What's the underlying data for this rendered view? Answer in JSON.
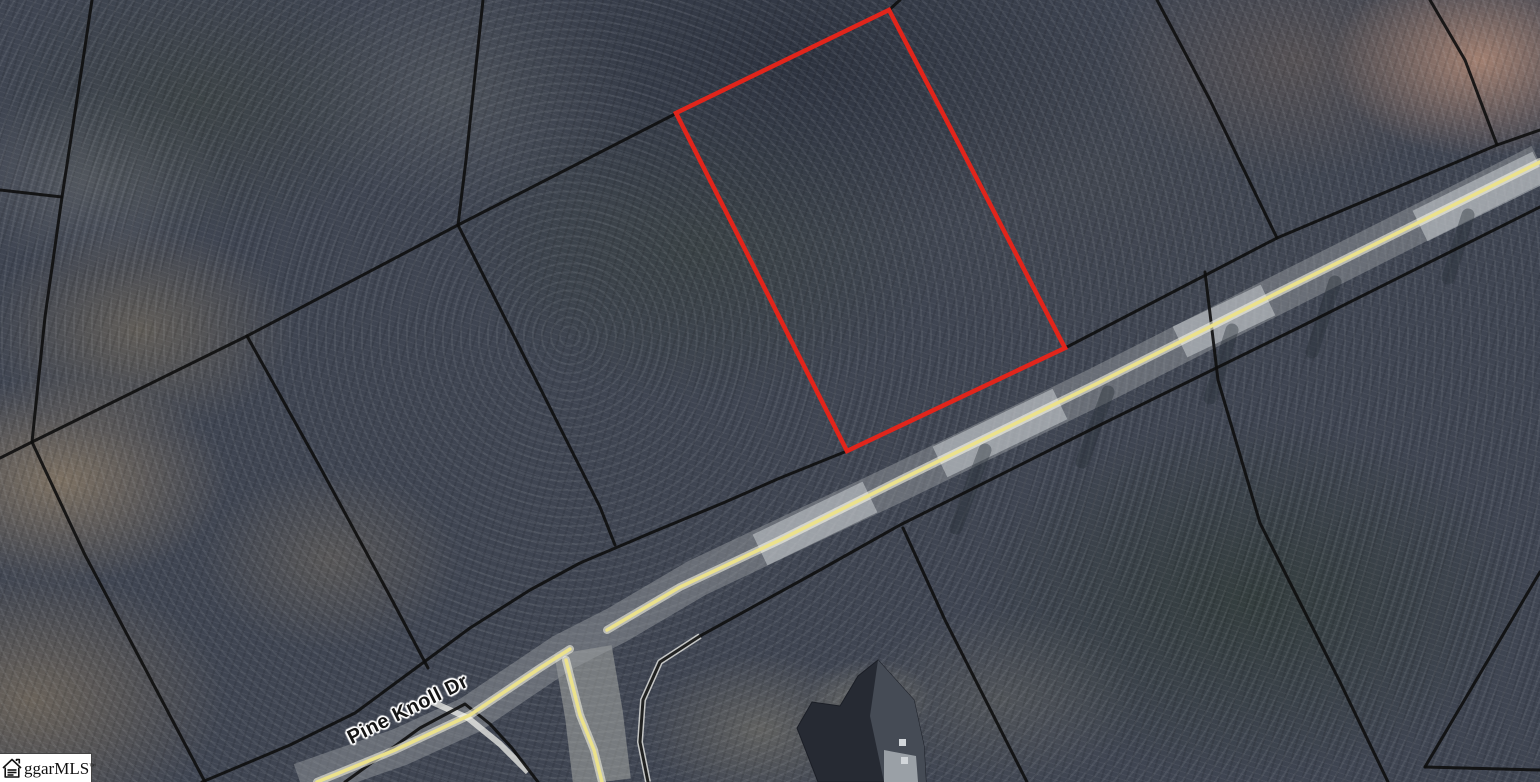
{
  "map": {
    "street_label": "Pine Knoll Dr",
    "watermark": {
      "text": "ggarMLS",
      "tm": "™",
      "icon": "house-icon"
    },
    "colors": {
      "parcel_highlight": "#e1251b",
      "boundary_line": "#0e0e0e",
      "road_centerline": "#ece28b",
      "watermark_bg": "#ffffff"
    }
  },
  "geometry": {
    "width": 1540,
    "height": 782,
    "features": [
      {
        "name": "side-road-surface",
        "class": "side-band",
        "shape": "polyline",
        "points": [
          [
            583,
            650
          ],
          [
            594,
            715
          ],
          [
            602,
            782
          ]
        ]
      },
      {
        "name": "main-road-surface",
        "class": "road-band",
        "shape": "polyline",
        "points": [
          [
            300,
            782
          ],
          [
            400,
            747
          ],
          [
            470,
            715
          ],
          [
            562,
            653
          ],
          [
            617,
            625
          ],
          [
            697,
            578
          ],
          [
            900,
            482
          ],
          [
            1100,
            385
          ],
          [
            1283,
            292
          ],
          [
            1540,
            163
          ]
        ]
      },
      {
        "name": "road-light-patch",
        "class": "road-light",
        "shape": "polyline",
        "points": [
          [
            760,
            550
          ],
          [
            870,
            497
          ]
        ]
      },
      {
        "name": "road-light-patch",
        "class": "road-light",
        "shape": "polyline",
        "points": [
          [
            940,
            462
          ],
          [
            1060,
            404
          ]
        ]
      },
      {
        "name": "road-light-patch",
        "class": "road-light",
        "shape": "polyline",
        "points": [
          [
            1180,
            342
          ],
          [
            1268,
            300
          ]
        ]
      },
      {
        "name": "road-light-patch",
        "class": "road-light",
        "shape": "polyline",
        "points": [
          [
            1420,
            226
          ],
          [
            1540,
            167
          ]
        ]
      },
      {
        "name": "tree-shadow-streak",
        "class": "shadow-streak",
        "shape": "polyline",
        "points": [
          [
            985,
            450
          ],
          [
            956,
            528
          ]
        ]
      },
      {
        "name": "tree-shadow-streak",
        "class": "shadow-streak",
        "shape": "polyline",
        "points": [
          [
            1108,
            392
          ],
          [
            1082,
            462
          ]
        ]
      },
      {
        "name": "tree-shadow-streak",
        "class": "shadow-streak",
        "shape": "polyline",
        "points": [
          [
            1232,
            330
          ],
          [
            1210,
            398
          ]
        ]
      },
      {
        "name": "tree-shadow-streak",
        "class": "shadow-streak",
        "shape": "polyline",
        "points": [
          [
            1335,
            282
          ],
          [
            1312,
            352
          ]
        ]
      },
      {
        "name": "tree-shadow-streak",
        "class": "shadow-streak",
        "shape": "polyline",
        "points": [
          [
            1468,
            215
          ],
          [
            1448,
            278
          ]
        ]
      },
      {
        "name": "curb-edge-white",
        "class": "white-curb",
        "shape": "polyline",
        "points": [
          [
            700,
            636
          ],
          [
            660,
            662
          ],
          [
            643,
            700
          ],
          [
            640,
            742
          ],
          [
            648,
            782
          ]
        ]
      },
      {
        "name": "curb-edge-white",
        "class": "white-curb",
        "shape": "polyline",
        "points": [
          [
            432,
            702
          ],
          [
            468,
            718
          ],
          [
            500,
            744
          ],
          [
            528,
            772
          ]
        ]
      },
      {
        "name": "parcel-boundary",
        "class": "black-line",
        "shape": "polyline",
        "points": [
          [
            92,
            0
          ],
          [
            83,
            60
          ],
          [
            62,
            197
          ],
          [
            45,
            317
          ],
          [
            32,
            442
          ]
        ]
      },
      {
        "name": "parcel-boundary",
        "class": "black-line",
        "shape": "polyline",
        "points": [
          [
            62,
            197
          ],
          [
            0,
            190
          ]
        ]
      },
      {
        "name": "parcel-boundary",
        "class": "black-line",
        "shape": "polyline",
        "points": [
          [
            247,
            336
          ],
          [
            32,
            442
          ],
          [
            0,
            458
          ]
        ]
      },
      {
        "name": "parcel-boundary",
        "class": "black-line",
        "shape": "polyline",
        "points": [
          [
            32,
            442
          ],
          [
            85,
            555
          ],
          [
            130,
            640
          ],
          [
            205,
            782
          ]
        ]
      },
      {
        "name": "parcel-boundary",
        "class": "black-line",
        "shape": "polyline",
        "points": [
          [
            483,
            0
          ],
          [
            466,
            160
          ],
          [
            458,
            225
          ]
        ]
      },
      {
        "name": "parcel-boundary",
        "class": "black-line",
        "shape": "polyline",
        "points": [
          [
            458,
            225
          ],
          [
            247,
            336
          ]
        ]
      },
      {
        "name": "parcel-boundary",
        "class": "black-line",
        "shape": "polyline",
        "points": [
          [
            247,
            336
          ],
          [
            320,
            467
          ],
          [
            392,
            600
          ],
          [
            428,
            668
          ]
        ]
      },
      {
        "name": "parcel-boundary",
        "class": "black-line",
        "shape": "polyline",
        "points": [
          [
            458,
            225
          ],
          [
            600,
            507
          ],
          [
            615,
            545
          ]
        ]
      },
      {
        "name": "parcel-boundary",
        "class": "black-line",
        "shape": "polyline",
        "points": [
          [
            458,
            225
          ],
          [
            677,
            113
          ]
        ]
      },
      {
        "name": "parcel-boundary",
        "class": "black-line",
        "shape": "polyline",
        "points": [
          [
            889,
            10
          ],
          [
            900,
            0
          ]
        ]
      },
      {
        "name": "road-frontage-boundary",
        "class": "black-line",
        "shape": "polyline",
        "points": [
          [
            202,
            782
          ],
          [
            290,
            745
          ],
          [
            355,
            713
          ],
          [
            420,
            665
          ],
          [
            470,
            628
          ],
          [
            530,
            590
          ],
          [
            580,
            563
          ],
          [
            653,
            532
          ],
          [
            723,
            503
          ],
          [
            780,
            478
          ],
          [
            847,
            451
          ],
          [
            1065,
            348
          ],
          [
            1277,
            238
          ],
          [
            1497,
            145
          ],
          [
            1540,
            130
          ]
        ]
      },
      {
        "name": "parcel-boundary",
        "class": "black-line",
        "shape": "polyline",
        "points": [
          [
            1157,
            0
          ],
          [
            1210,
            100
          ],
          [
            1277,
            238
          ]
        ]
      },
      {
        "name": "parcel-boundary",
        "class": "black-line",
        "shape": "polyline",
        "points": [
          [
            1430,
            0
          ],
          [
            1465,
            60
          ],
          [
            1497,
            145
          ]
        ]
      },
      {
        "name": "road-lower-curb",
        "class": "black-line",
        "shape": "polyline",
        "points": [
          [
            345,
            782
          ],
          [
            420,
            728
          ],
          [
            465,
            704
          ],
          [
            490,
            724
          ],
          [
            512,
            748
          ],
          [
            538,
            782
          ]
        ]
      },
      {
        "name": "road-lower-curb",
        "class": "black-line",
        "shape": "polyline",
        "points": [
          [
            648,
            782
          ],
          [
            640,
            742
          ],
          [
            643,
            700
          ],
          [
            660,
            662
          ],
          [
            700,
            636
          ],
          [
            820,
            570
          ],
          [
            900,
            525
          ],
          [
            1100,
            425
          ],
          [
            1300,
            327
          ],
          [
            1540,
            207
          ]
        ]
      },
      {
        "name": "parcel-boundary",
        "class": "black-line",
        "shape": "polyline",
        "points": [
          [
            1205,
            272
          ],
          [
            1218,
            380
          ],
          [
            1260,
            523
          ],
          [
            1340,
            682
          ],
          [
            1388,
            782
          ]
        ]
      },
      {
        "name": "parcel-boundary",
        "class": "black-line",
        "shape": "polyline",
        "points": [
          [
            903,
            528
          ],
          [
            945,
            620
          ],
          [
            1027,
            782
          ]
        ]
      },
      {
        "name": "parcel-boundary",
        "class": "black-line",
        "shape": "polyline",
        "points": [
          [
            1540,
            572
          ],
          [
            1425,
            767
          ]
        ]
      },
      {
        "name": "parcel-boundary",
        "class": "black-line",
        "shape": "polyline",
        "points": [
          [
            1425,
            767
          ],
          [
            1540,
            770
          ]
        ]
      },
      {
        "name": "highlighted-parcel-outline",
        "class": "red-parcel",
        "shape": "polygon",
        "points": [
          [
            889,
            10
          ],
          [
            1065,
            348
          ],
          [
            847,
            451
          ],
          [
            676,
            113
          ]
        ]
      },
      {
        "name": "road-centerline-glow",
        "class": "yellow-glow",
        "shape": "polyline",
        "points": [
          [
            317,
            782
          ],
          [
            395,
            750
          ],
          [
            470,
            715
          ],
          [
            540,
            668
          ],
          [
            570,
            649
          ]
        ]
      },
      {
        "name": "road-centerline-glow",
        "class": "yellow-glow",
        "shape": "polyline",
        "points": [
          [
            607,
            630
          ],
          [
            680,
            587
          ],
          [
            780,
            540
          ],
          [
            900,
            480
          ],
          [
            1100,
            382
          ],
          [
            1283,
            290
          ],
          [
            1540,
            162
          ]
        ]
      },
      {
        "name": "road-centerline-glow",
        "class": "yellow-glow",
        "shape": "polyline",
        "points": [
          [
            566,
            660
          ],
          [
            580,
            715
          ],
          [
            594,
            750
          ],
          [
            602,
            782
          ]
        ]
      },
      {
        "name": "road-centerline",
        "class": "yellow-line",
        "shape": "polyline",
        "points": [
          [
            317,
            782
          ],
          [
            395,
            750
          ],
          [
            470,
            715
          ],
          [
            540,
            668
          ],
          [
            570,
            649
          ]
        ]
      },
      {
        "name": "road-centerline",
        "class": "yellow-line",
        "shape": "polyline",
        "points": [
          [
            607,
            630
          ],
          [
            680,
            587
          ],
          [
            780,
            540
          ],
          [
            900,
            480
          ],
          [
            1100,
            382
          ],
          [
            1283,
            290
          ],
          [
            1540,
            162
          ]
        ]
      },
      {
        "name": "road-centerline",
        "class": "yellow-line",
        "shape": "polyline",
        "points": [
          [
            566,
            660
          ],
          [
            580,
            715
          ],
          [
            594,
            750
          ],
          [
            602,
            782
          ]
        ]
      },
      {
        "name": "house-roof",
        "class": "house-roof",
        "shape": "polygon",
        "points": [
          [
            878,
            660
          ],
          [
            914,
            700
          ],
          [
            924,
            746
          ],
          [
            926,
            782
          ],
          [
            818,
            782
          ],
          [
            797,
            728
          ],
          [
            812,
            702
          ],
          [
            840,
            706
          ],
          [
            858,
            676
          ]
        ]
      },
      {
        "name": "house-roof-facet",
        "class": "house-facet",
        "shape": "polygon",
        "points": [
          [
            878,
            660
          ],
          [
            914,
            700
          ],
          [
            924,
            746
          ],
          [
            926,
            782
          ],
          [
            884,
            782
          ],
          [
            870,
            716
          ]
        ]
      },
      {
        "name": "house-roof-light-section",
        "class": "house-light",
        "shape": "polygon",
        "points": [
          [
            884,
            750
          ],
          [
            916,
            756
          ],
          [
            918,
            782
          ],
          [
            884,
            782
          ]
        ]
      },
      {
        "name": "house-roof-detail",
        "class": "house-dot",
        "shape": "polygon",
        "points": [
          [
            899,
            739
          ],
          [
            906,
            739
          ],
          [
            906,
            746
          ],
          [
            899,
            746
          ]
        ]
      },
      {
        "name": "house-roof-detail",
        "class": "house-dot",
        "shape": "polygon",
        "points": [
          [
            901,
            757
          ],
          [
            908,
            757
          ],
          [
            908,
            764
          ],
          [
            901,
            764
          ]
        ]
      }
    ]
  }
}
